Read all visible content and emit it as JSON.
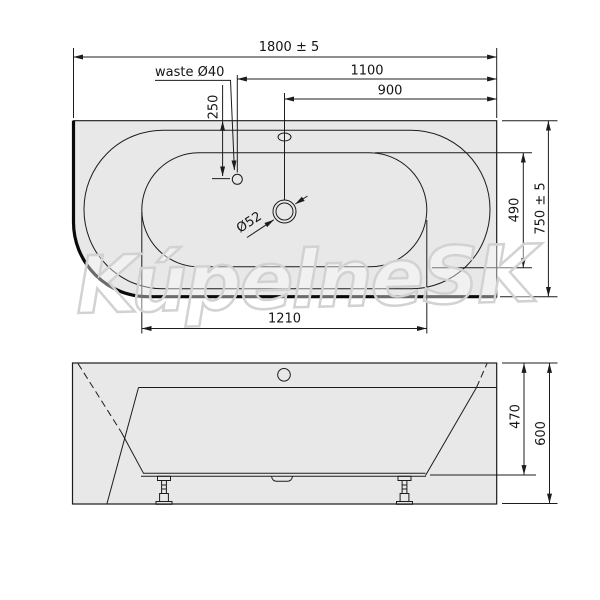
{
  "watermark": {
    "text": "KúpelneSK"
  },
  "colors": {
    "paper": "#ffffff",
    "body_fill": "#e8e8e8",
    "line": "#1c1c1c",
    "watermark_stroke": "#d2d2d2"
  },
  "plan": {
    "view_name": "bathtub plan view",
    "labels": {
      "overall_length": "1800 ± 5",
      "dist_waste": "1100",
      "dist_overflow": "900",
      "waste": "waste Ø40",
      "waste_offset_y": "250",
      "overflow_dia": "Ø52",
      "basin_width": "490",
      "overall_width": "750 ± 5",
      "basin_length": "1210"
    }
  },
  "front": {
    "view_name": "bathtub front elevation",
    "labels": {
      "rim_height": "470",
      "overall_height": "600"
    }
  }
}
